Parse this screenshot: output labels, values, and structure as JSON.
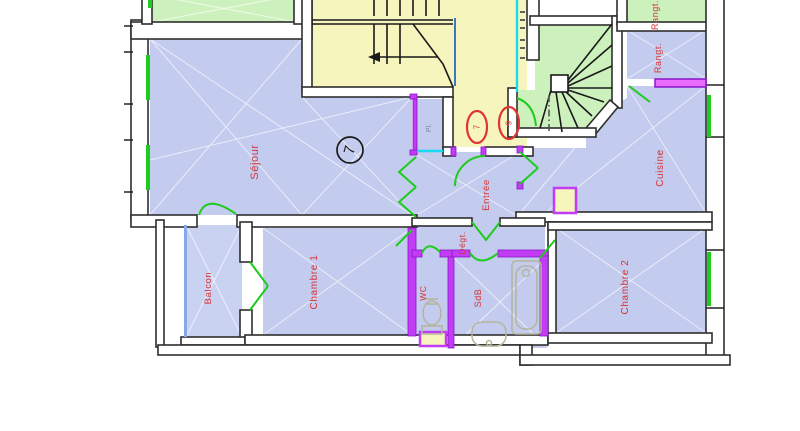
{
  "plan": {
    "unit_badge": "7",
    "landing_door_badges": [
      "7",
      "9"
    ],
    "rooms": {
      "sejour": {
        "label": "Séjour"
      },
      "entree": {
        "label": "Entrée"
      },
      "cuisine": {
        "label": "Cuisine"
      },
      "rangement": {
        "label": "Rangt."
      },
      "rangement_top": {
        "label": "Rangt."
      },
      "chambre1": {
        "label": "Chambre 1"
      },
      "chambre2": {
        "label": "Chambre 2"
      },
      "balcon": {
        "label": "Balcon"
      },
      "wc": {
        "label": "WC"
      },
      "sdb": {
        "label": "SdB"
      },
      "degagement": {
        "label": "Dégt."
      },
      "placard": {
        "label": "Pl."
      }
    },
    "colors": {
      "room_fill": "#c3cbee",
      "stair_fill": "#f5f5bd",
      "service_fill": "#cdf1bd",
      "wall_outline": "#2e2e2e",
      "door_window_green": "#1ecb1e",
      "partition_magenta": "#c23cf5",
      "marker_cyan": "#17d9f2",
      "stair_rail_blue": "#3a7ac0",
      "label_red": "#d63434"
    }
  }
}
